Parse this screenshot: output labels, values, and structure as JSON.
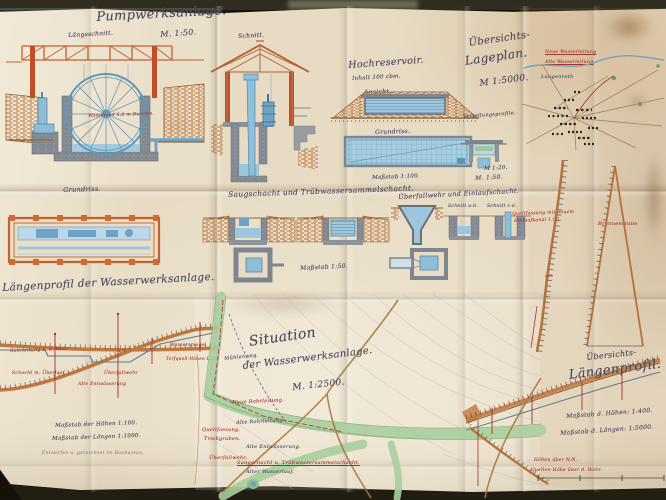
{
  "pumpwerk": {
    "title": "Pumpwerksanlage.",
    "scale": "M. 1:50.",
    "laengsschnitt_label": "Längsschnitt.",
    "schnitt_label": "Schnitt.",
    "grundriss_label": "Grundriss.",
    "wheel_note": "Wasserrad 5,0 m Durchm."
  },
  "reservoir": {
    "title": "Hochreservoir.",
    "subtitle": "Inhalt 100 cbm.",
    "ansicht_label": "Ansicht.",
    "grundriss_label": "Grundriss.",
    "scale": "Maßstab 1:100.",
    "small_scale": "M 1:20.",
    "profil_label": "Verteilungsprofile."
  },
  "lageplan": {
    "title_line1": "Übersichts-",
    "title_line2": "Lageplan.",
    "scale": "M 1:5000.",
    "village": "Langenroth",
    "note1": "Neue Wasserleitung",
    "note2": "Alte Wasserleitung"
  },
  "schacht_row": {
    "scale_top": "M. 1:50.",
    "title_left": "Saugschacht und Trübwassersammelschacht.",
    "title_right": "Überfallwehr und Einlaufschacht.",
    "schnitt_ab": "Schnitt a-b.",
    "schnitt_cd": "Schnitt c-d.",
    "scale_mid": "Maßstab 1:50.",
    "red_note1": "Quellfassung mit neuem",
    "red_note2": "Einlaufkanal 1:50.",
    "red_note3": "Brunnenstube"
  },
  "profil_links": {
    "title": "Längenprofil der Wasserwerksanlage.",
    "scale_h": "Maßstab der Höhen 1:100.",
    "scale_l": "Maßstab der Längen 1:1000.",
    "vermerk": "Entworfen u. gezeichnet im Baubureau.",
    "ann1": "Rohrleitung ü. d. Wehr",
    "ann2": "Schacht m. Überlauf",
    "ann3": "Alte Entwässerung",
    "ann4": "Überfallwehr",
    "ann5": "Wasserspiegel",
    "ann6": "Torfquell-Höhen-Linie"
  },
  "situation": {
    "title_line1": "Situation",
    "title_line2": "der Wasserwerksanlage.",
    "scale": "M. 1:2500.",
    "lbl_neue": "Neue Rohrleitung.",
    "lbl_alte": "Alte Rohrleitung.",
    "lbl_quellfassung": "Quellfassung.",
    "lbl_triebgraben": "Triebgraben.",
    "lbl_wehr": "Überfallwehr.",
    "lbl_saugschacht": "Saugschacht u. Trübwassersammelschacht.",
    "lbl_wasserlauf": "Alter Wasserlauf.",
    "lbl_weg": "Mühlenweg.",
    "lbl_entw": "Alte Entwässerung."
  },
  "profil_rechts": {
    "title_line1": "Übersichts-",
    "title_line2": "Längenprofil.",
    "scale_h": "Maßstab d. Höhen: 1:400.",
    "scale_l": "Maßstab d. Längen: 1:5000.",
    "red1": "Höhen über N.N.",
    "red2": "Quellen-Höhe über d. Wehr."
  },
  "colors": {
    "paper": "#e7dbc3",
    "ink": "#4e4960",
    "red_ink": "#a33228",
    "blue_water": "#9cc6dd",
    "orange_structure": "#c2602f",
    "green_stream": "#a8cf9e",
    "masonry_gray": "#8d939b"
  }
}
